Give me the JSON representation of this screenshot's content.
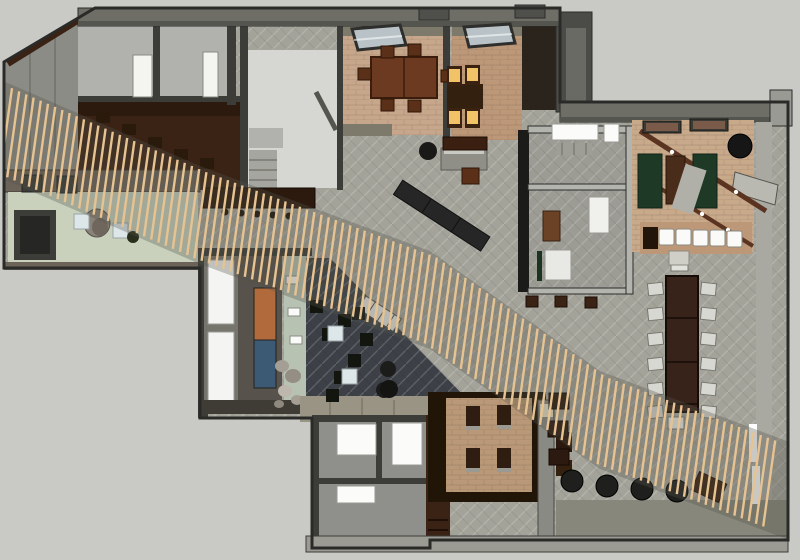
{
  "meta": {
    "description": "Top-down 3D architectural floor plan render (SketchUp style) of an office/hospitality interior with a diagonal wood-slat canopy band",
    "width": 800,
    "height": 560
  },
  "palette": {
    "bg": "#c9c9c5",
    "line": "#2a2a28",
    "wall-dark": "#3c3c39",
    "wall-mid": "#6e6e67",
    "wall-face": "#55554f",
    "wall-light": "#b4b4ae",
    "wall-taupe": "#6b6258",
    "terrace": "#8c8c86",
    "carpet": "#a3a39a",
    "floor-light": "#d6d6d2",
    "floor-office": "#b1b1ad",
    "floor-room": "#8f8f8b",
    "walnut": "#3a2315",
    "wood-table": "#6b3a20",
    "wood-dark": "#2c1a0e",
    "brick": "#c7a78b",
    "brick-warm": "#bd9878",
    "brick-booth": "#b99877",
    "sage": "#c9d1bd",
    "glass-sage": "#b7c2b2",
    "lounge": "#3d4147",
    "skylight": "#b9c3c7",
    "slat": "#e7c392",
    "band-shadow": "#55554c",
    "amber": "#f2c268",
    "felt": "#1e3a26",
    "olive": "#9a9485",
    "olive-band": "#87877b",
    "art-orange": "#b06a3c",
    "art-blue": "#3c5a74",
    "stone": "#a49e95",
    "cream": "#e9e0c6"
  },
  "areas": [
    "terrace",
    "office-a",
    "office-b",
    "service-room",
    "corridor",
    "dining-room",
    "booth-dining-room",
    "entry-lobby",
    "lounge",
    "gallery-wall",
    "central-open-area",
    "games-room",
    "meeting-rooms",
    "communal-table-area",
    "booth-platform",
    "restrooms",
    "bottom-patio-band",
    "slat-canopy"
  ],
  "slat_band": {
    "x_start": 6,
    "x_end": 770,
    "spacing": 7.2,
    "half_length": 43,
    "lean": 6,
    "stroke_width": 2.4,
    "shadow_pad": 6,
    "shadow_opacity": 0.32,
    "centers": [
      [
        -20,
        120
      ],
      [
        200,
        215
      ],
      [
        430,
        300
      ],
      [
        600,
        420
      ],
      [
        800,
        495
      ]
    ]
  },
  "stamps": [
    {
      "name": "office-whiteboard",
      "shape": "rect",
      "w": 19,
      "h": 42,
      "fill": "#f4f4f1",
      "stroke": "#8a8a84",
      "positions": [
        [
          133,
          55
        ]
      ]
    },
    {
      "name": "office-whiteboard-b",
      "shape": "rect",
      "w": 15,
      "h": 45,
      "fill": "#f4f4f1",
      "stroke": "#8a8a84",
      "positions": [
        [
          203,
          52
        ]
      ]
    },
    {
      "name": "dining-chair",
      "shape": "rect",
      "w": 13,
      "h": 12,
      "fill": "#5a3018",
      "stroke": "#2f1608",
      "positions": [
        [
          381,
          46
        ],
        [
          408,
          44
        ],
        [
          381,
          99
        ],
        [
          408,
          100
        ],
        [
          358,
          68
        ],
        [
          441,
          70
        ]
      ]
    },
    {
      "name": "booth-seat-frame",
      "shape": "rect",
      "w": 15,
      "h": 20,
      "fill": "#3a2212",
      "positions": [
        [
          447,
          66
        ],
        [
          465,
          65
        ],
        [
          447,
          108
        ],
        [
          465,
          108
        ]
      ]
    },
    {
      "name": "booth-seat-cushion",
      "shape": "rect",
      "w": 11,
      "h": 13,
      "fill": "#f2c268",
      "positions": [
        [
          449,
          69
        ],
        [
          467,
          68
        ],
        [
          449,
          111
        ],
        [
          467,
          111
        ]
      ]
    },
    {
      "name": "bar-stool-dot",
      "shape": "circle",
      "r": 3.5,
      "fill": "#1b130c",
      "positions": [
        [
          225,
          212
        ],
        [
          241,
          213
        ],
        [
          257,
          214
        ],
        [
          273,
          215
        ],
        [
          289,
          216
        ]
      ]
    },
    {
      "name": "corridor-table",
      "shape": "rect",
      "w": 14,
      "h": 11,
      "fill": "#2a1a0c",
      "positions": [
        [
          96,
          112
        ],
        [
          122,
          124
        ],
        [
          148,
          137
        ],
        [
          174,
          149
        ],
        [
          200,
          158
        ]
      ]
    },
    {
      "name": "lounge-cube-stool",
      "shape": "rect",
      "w": 13,
      "h": 13,
      "fill": "#12160f",
      "positions": [
        [
          338,
          314
        ],
        [
          322,
          328
        ],
        [
          348,
          354
        ],
        [
          334,
          371
        ],
        [
          360,
          333
        ],
        [
          310,
          300
        ],
        [
          352,
          307
        ],
        [
          326,
          389
        ]
      ]
    },
    {
      "name": "lounge-table",
      "shape": "rect",
      "w": 15,
      "h": 15,
      "fill": "#dde6e9",
      "stroke": "#9aa5a8",
      "positions": [
        [
          328,
          326
        ],
        [
          342,
          369
        ]
      ]
    },
    {
      "name": "wall-shelf",
      "shape": "rect",
      "w": 12,
      "h": 8,
      "fill": "#fafaf8",
      "stroke": "#8a8a84",
      "positions": [
        [
          286,
          276
        ],
        [
          288,
          308
        ],
        [
          290,
          336
        ]
      ]
    },
    {
      "name": "lounge-ottoman",
      "shape": "circle",
      "r": 8,
      "fill": "#1c1c1b",
      "positions": [
        [
          388,
          369
        ],
        [
          384,
          390
        ]
      ]
    },
    {
      "name": "communal-chair-left",
      "shape": "rect",
      "w": 15,
      "h": 12,
      "fill": "#d8d8d2",
      "stroke": "#77776f",
      "rot": -6,
      "positions": [
        [
          648,
          283
        ],
        [
          648,
          308
        ],
        [
          648,
          333
        ],
        [
          648,
          358
        ],
        [
          648,
          383
        ],
        [
          648,
          406
        ]
      ]
    },
    {
      "name": "communal-chair-right",
      "shape": "rect",
      "w": 15,
      "h": 12,
      "fill": "#d8d8d2",
      "stroke": "#77776f",
      "rot": 6,
      "positions": [
        [
          701,
          283
        ],
        [
          701,
          308
        ],
        [
          701,
          333
        ],
        [
          701,
          358
        ],
        [
          701,
          383
        ],
        [
          701,
          406
        ]
      ]
    },
    {
      "name": "communal-chair-head",
      "shape": "rect",
      "w": 17,
      "h": 13,
      "fill": "#e2e2dc",
      "stroke": "#77776f",
      "positions": [
        [
          671,
          258
        ]
      ]
    },
    {
      "name": "communal-chair-foot",
      "shape": "rect",
      "w": 16,
      "h": 12,
      "fill": "#eeeeea",
      "stroke": "#77776f",
      "positions": [
        [
          668,
          417
        ]
      ]
    },
    {
      "name": "communal-head-table",
      "shape": "rect",
      "w": 20,
      "h": 14,
      "fill": "#cfcfc8",
      "stroke": "#8a8a82",
      "positions": [
        [
          669,
          251
        ]
      ]
    },
    {
      "name": "games-bench-cushion",
      "shape": "rect",
      "w": 15,
      "h": 16,
      "rx": 2,
      "fill": "#fafaf8",
      "stroke": "#8a8a82",
      "positions": [
        [
          659,
          229
        ],
        [
          676,
          229
        ],
        [
          693,
          230
        ],
        [
          710,
          230
        ],
        [
          727,
          231
        ]
      ]
    },
    {
      "name": "bench-texture-block",
      "shape": "rect",
      "w": 15,
      "h": 22,
      "fill": "#24150a",
      "positions": [
        [
          643,
          227
        ]
      ]
    },
    {
      "name": "floor-cylinder-stool",
      "shape": "circle",
      "r": 11,
      "fill": "#1f1f1e",
      "stroke": "#000000",
      "positions": [
        [
          572,
          481
        ],
        [
          607,
          486
        ],
        [
          642,
          489
        ],
        [
          677,
          491
        ]
      ]
    },
    {
      "name": "corner-ottoman",
      "shape": "rect",
      "w": 30,
      "h": 20,
      "fill": "#3a2213",
      "stroke": "#1c0e05",
      "rot": 25,
      "positions": [
        [
          694,
          477
        ]
      ]
    },
    {
      "name": "meeting-stool",
      "shape": "rect",
      "w": 12,
      "h": 11,
      "fill": "#3a2314",
      "stroke": "#1c0e05",
      "positions": [
        [
          526,
          296
        ],
        [
          555,
          296
        ],
        [
          585,
          297
        ]
      ]
    },
    {
      "name": "storage-box",
      "shape": "rect",
      "w": 20,
      "h": 16,
      "fill": "#2c1a10",
      "stroke": "#140a04",
      "positions": [
        [
          549,
          393
        ],
        [
          548,
          421
        ],
        [
          549,
          449
        ]
      ]
    },
    {
      "name": "booth-bench",
      "shape": "rect",
      "w": 14,
      "h": 22,
      "fill": "#2f1d12",
      "positions": [
        [
          466,
          406
        ],
        [
          497,
          405
        ],
        [
          466,
          448
        ],
        [
          497,
          448
        ]
      ]
    },
    {
      "name": "booth-bench-base",
      "shape": "rect",
      "w": 14,
      "h": 4,
      "fill": "#9a9a92",
      "positions": [
        [
          466,
          426
        ],
        [
          497,
          425
        ],
        [
          466,
          468
        ],
        [
          497,
          468
        ]
      ]
    },
    {
      "name": "restroom-fixture-a",
      "shape": "rect",
      "w": 39,
      "h": 31,
      "fill": "#fbfbf9",
      "stroke": "#9a9a94",
      "positions": [
        [
          337,
          424
        ]
      ]
    },
    {
      "name": "restroom-fixture-b",
      "shape": "rect",
      "w": 30,
      "h": 42,
      "fill": "#fbfbf9",
      "stroke": "#9a9a94",
      "positions": [
        [
          392,
          423
        ]
      ]
    },
    {
      "name": "restroom-fixture-c",
      "shape": "rect",
      "w": 38,
      "h": 17,
      "fill": "#fbfbf9",
      "stroke": "#9a9a94",
      "positions": [
        [
          337,
          486
        ]
      ]
    },
    {
      "name": "meeting-table",
      "shape": "rect",
      "w": 20,
      "h": 36,
      "fill": "#f0f0ec",
      "stroke": "#9a9a94",
      "positions": [
        [
          589,
          197
        ]
      ]
    },
    {
      "name": "meeting-sofa",
      "shape": "rect",
      "w": 17,
      "h": 30,
      "fill": "#6b4226",
      "stroke": "#3a2212",
      "positions": [
        [
          543,
          211
        ]
      ]
    },
    {
      "name": "meeting-daybed",
      "shape": "rect",
      "w": 26,
      "h": 30,
      "fill": "#e8e8e4",
      "stroke": "#9a9a94",
      "positions": [
        [
          545,
          250
        ]
      ]
    },
    {
      "name": "green-cabinet",
      "shape": "rect",
      "w": 5,
      "h": 30,
      "fill": "#1d3322",
      "positions": [
        [
          537,
          251
        ]
      ]
    },
    {
      "name": "counter-white",
      "shape": "rect",
      "w": 46,
      "h": 16,
      "fill": "#fbfbf9",
      "stroke": "#9a9a94",
      "positions": [
        [
          552,
          124
        ]
      ]
    },
    {
      "name": "counter-white-b",
      "shape": "rect",
      "w": 15,
      "h": 18,
      "fill": "#fbfbf9",
      "stroke": "#9a9a94",
      "positions": [
        [
          604,
          124
        ]
      ]
    },
    {
      "name": "entry-side-table",
      "shape": "rect",
      "w": 15,
      "h": 15,
      "fill": "#dde6e9",
      "stroke": "#9aa5a8",
      "positions": [
        [
          74,
          214
        ],
        [
          113,
          223
        ]
      ]
    },
    {
      "name": "plant-pot",
      "shape": "circle",
      "r": 6,
      "fill": "#2a2e1c",
      "positions": [
        [
          133,
          237
        ]
      ]
    },
    {
      "name": "wall-art-frame",
      "shape": "rect",
      "w": 38,
      "h": 12,
      "fill": "#3a3a36",
      "stroke": "#151513",
      "positions": [
        [
          643,
          121
        ],
        [
          690,
          119
        ]
      ]
    },
    {
      "name": "wall-art-canvas",
      "shape": "rect",
      "w": 32,
      "h": 8,
      "fill": "#7a5a48",
      "positions": [
        [
          646,
          123
        ],
        [
          693,
          121
        ]
      ]
    },
    {
      "name": "shuffleboard-mat",
      "shape": "rect",
      "w": 24,
      "h": 54,
      "fill": "#1e3a26",
      "stroke": "#0f2316",
      "positions": [
        [
          638,
          154
        ],
        [
          693,
          154
        ]
      ]
    },
    {
      "name": "shuffleboard-table",
      "shape": "rect",
      "w": 19,
      "h": 48,
      "fill": "#4a2c1a",
      "stroke": "#2a170c",
      "positions": [
        [
          666,
          156
        ]
      ]
    },
    {
      "name": "games-wedge",
      "shape": "rect",
      "w": 22,
      "h": 46,
      "fill": "#b0b0a8",
      "rot": 18,
      "positions": [
        [
          678,
          166
        ]
      ]
    },
    {
      "name": "games-drum-light",
      "shape": "circle",
      "r": 12,
      "fill": "#161616",
      "stroke": "#000000",
      "positions": [
        [
          740,
          146
        ]
      ]
    },
    {
      "name": "sideboard",
      "shape": "rect",
      "w": 44,
      "h": 13,
      "fill": "#3b1f10",
      "stroke": "#1c0e05",
      "positions": [
        [
          443,
          137
        ]
      ]
    },
    {
      "name": "roof-vent",
      "shape": "rect",
      "w": 30,
      "h": 13,
      "fill": "#4f4f4b",
      "stroke": "#2c2c2a",
      "positions": [
        [
          419,
          7
        ],
        [
          515,
          5
        ]
      ]
    },
    {
      "name": "terrace-unit",
      "shape": "rect",
      "w": 20,
      "h": 17,
      "fill": "#3c3c39",
      "stroke": "#242422",
      "positions": [
        [
          22,
          175
        ],
        [
          57,
          176
        ]
      ]
    },
    {
      "name": "host-stool",
      "shape": "circle",
      "r": 9,
      "fill": "#191918",
      "positions": [
        [
          428,
          151
        ]
      ]
    },
    {
      "name": "lounge-round-ottoman",
      "shape": "circle",
      "r": 9,
      "fill": "#141413",
      "positions": [
        [
          389,
          389
        ]
      ]
    },
    {
      "name": "slat-light-strip",
      "shape": "rect",
      "w": 8,
      "h": 38,
      "fill": "#ffffff",
      "positions": [
        [
          749,
          424
        ],
        [
          752,
          466
        ]
      ]
    }
  ]
}
